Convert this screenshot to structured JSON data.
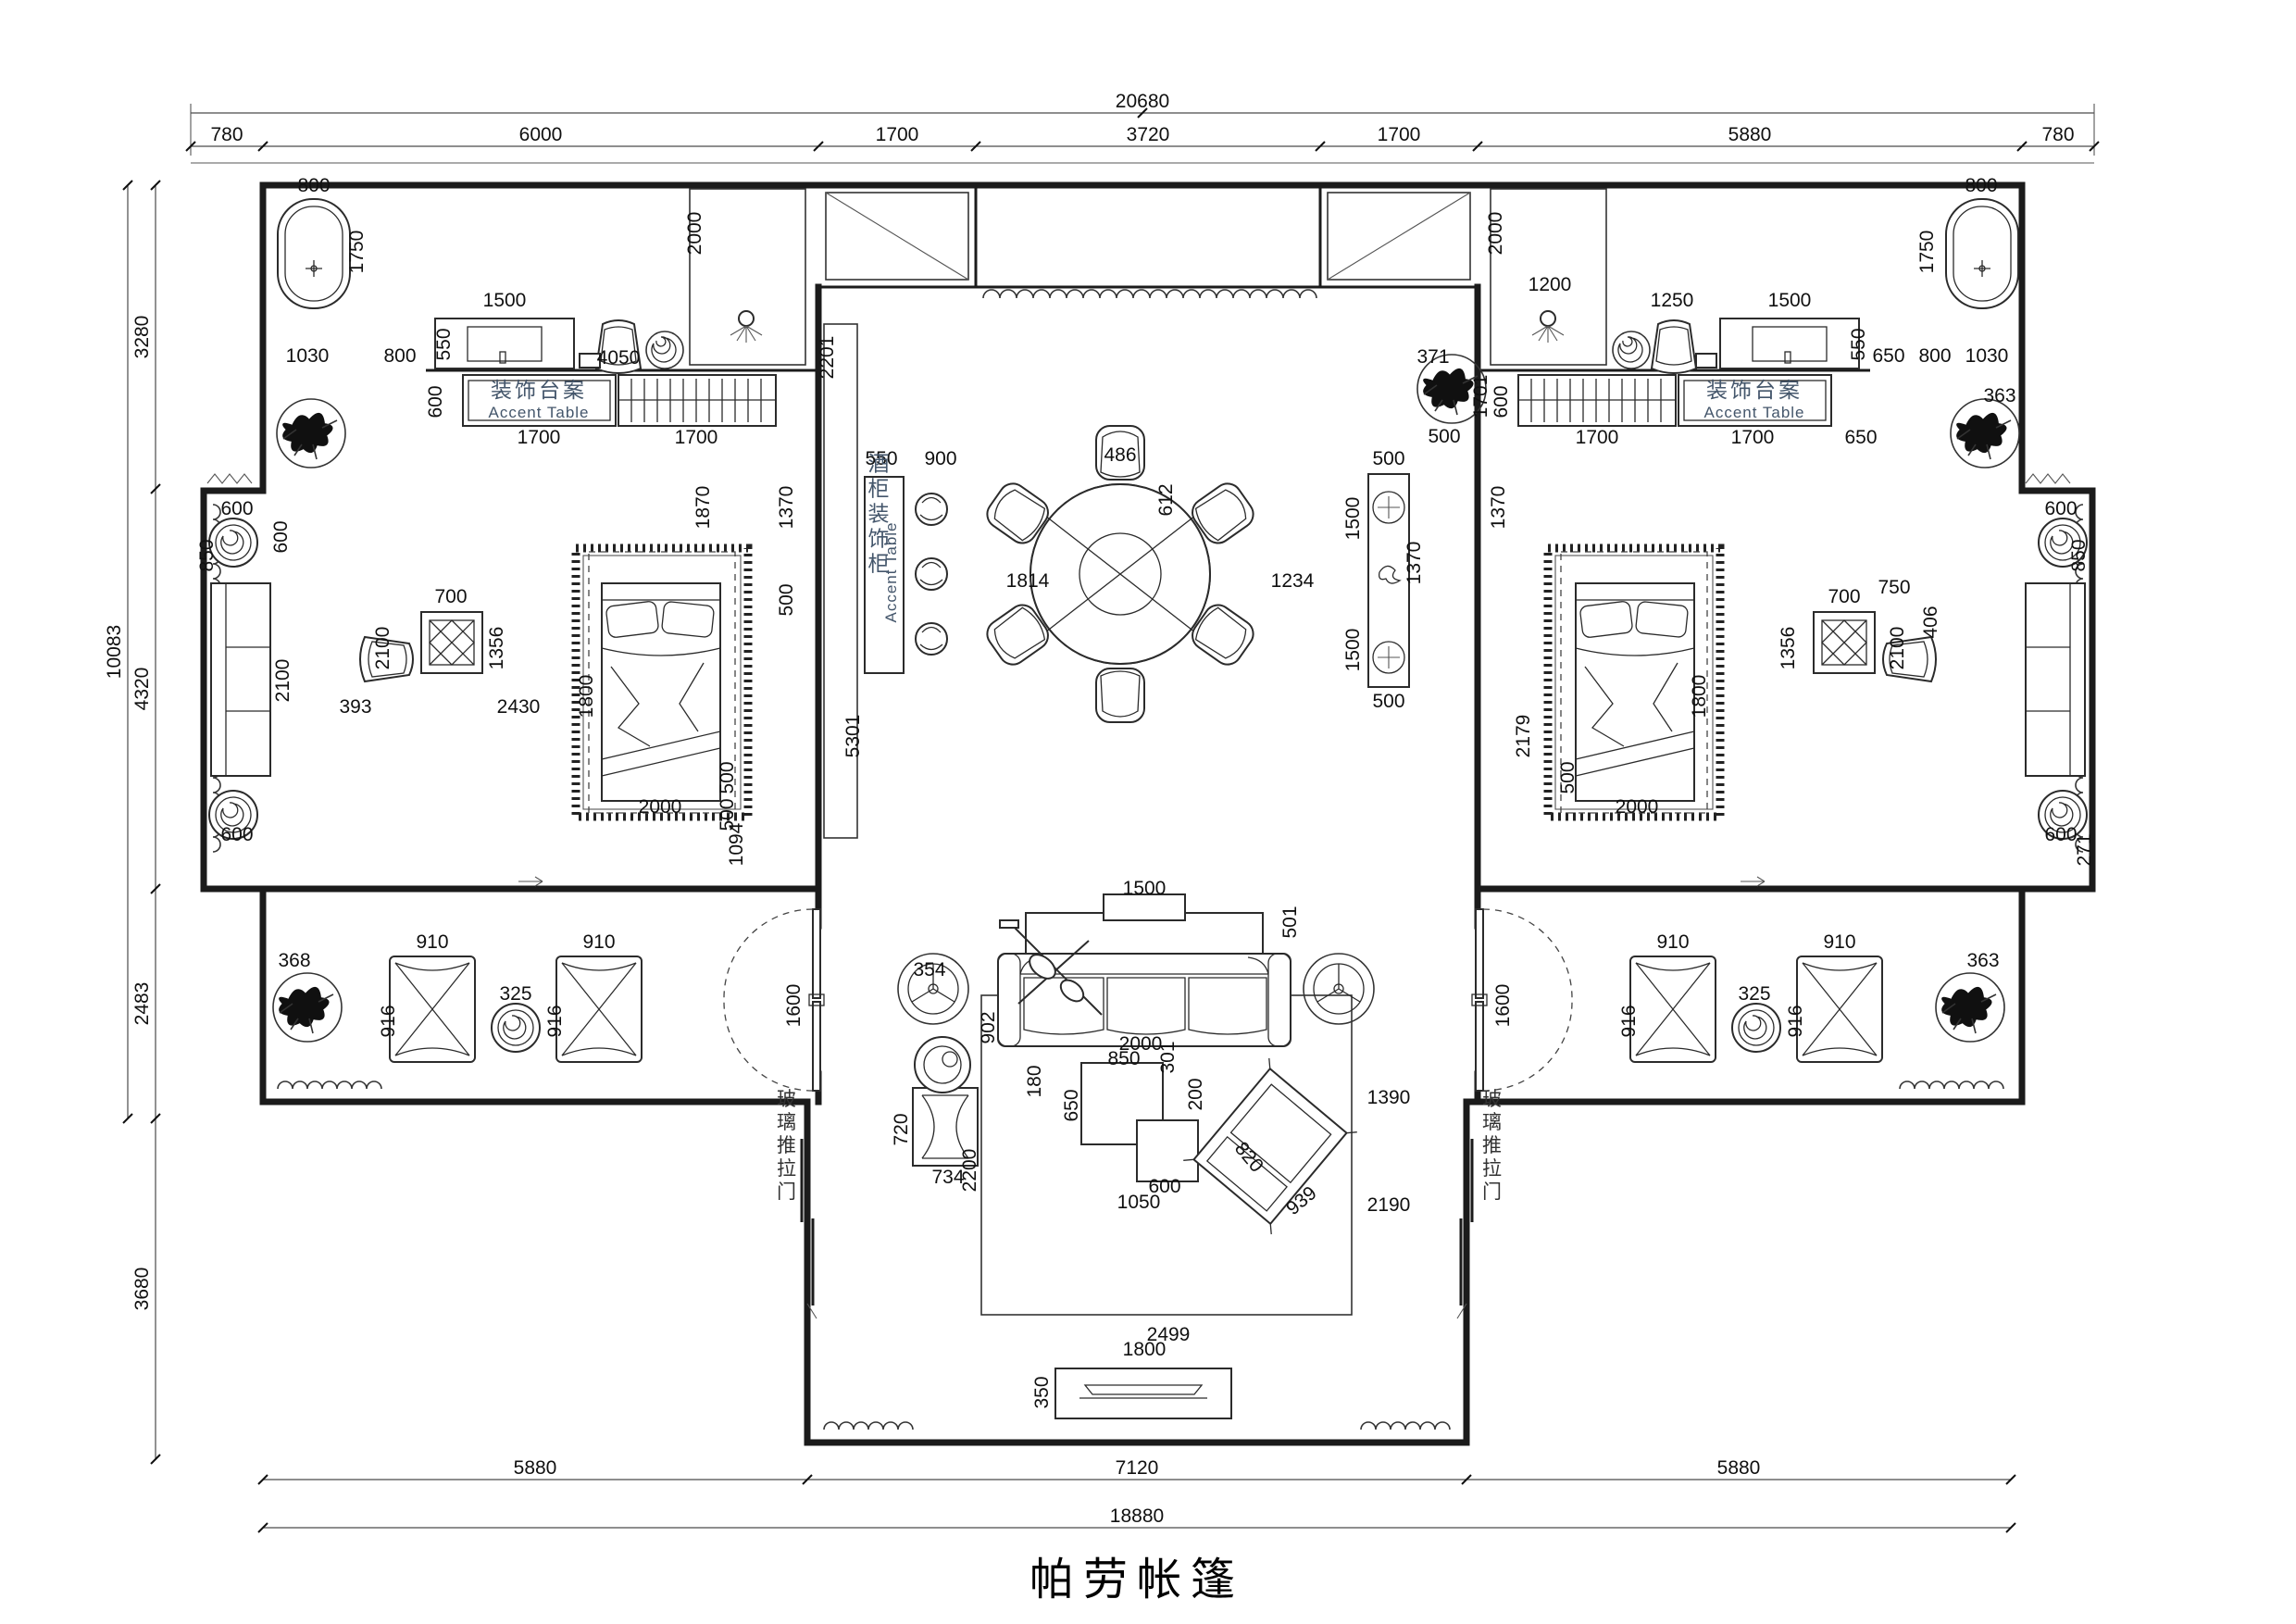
{
  "title": "帕劳帐篷",
  "labels": {
    "accent_table_cn": "装饰台案",
    "accent_table_en": "Accent Table",
    "bar_cabinet_cn": "酒柜装饰柜",
    "bar_cabinet_en": "Accent Table",
    "sliding_door": "玻璃推拉门"
  },
  "dimensions": {
    "top_total": "20680",
    "top_segments": [
      "780",
      "6000",
      "1700",
      "3720",
      "1700",
      "5880",
      "780"
    ],
    "left_total": "10083",
    "left_segments": [
      "3280",
      "4320",
      "2483"
    ],
    "left_lower": "3680",
    "bottom_segments": [
      "5880",
      "7120",
      "5880"
    ],
    "bottom_total": "18880"
  },
  "annotations": [
    [
      "20680",
      1234,
      116
    ],
    [
      "780",
      245,
      152
    ],
    [
      "6000",
      584,
      152
    ],
    [
      "1700",
      969,
      152
    ],
    [
      "3720",
      1240,
      152
    ],
    [
      "1700",
      1511,
      152
    ],
    [
      "5880",
      1890,
      152
    ],
    [
      "780",
      2223,
      152
    ],
    [
      "10083",
      130,
      704,
      -90
    ],
    [
      "3280",
      160,
      364,
      -90
    ],
    [
      "4320",
      160,
      744,
      -90
    ],
    [
      "2483",
      160,
      1084,
      -90
    ],
    [
      "3680",
      160,
      1392,
      -90
    ],
    [
      "5880",
      578,
      1592
    ],
    [
      "7120",
      1228,
      1592
    ],
    [
      "5880",
      1878,
      1592
    ],
    [
      "18880",
      1228,
      1644
    ],
    [
      "800",
      339,
      207
    ],
    [
      "1750",
      392,
      272,
      -90
    ],
    [
      "1030",
      332,
      391
    ],
    [
      "800",
      432,
      391
    ],
    [
      "550",
      486,
      372,
      -90
    ],
    [
      "1500",
      545,
      331
    ],
    [
      "4050",
      668,
      393
    ],
    [
      "600",
      477,
      434,
      -90
    ],
    [
      "1700",
      582,
      479
    ],
    [
      "1700",
      752,
      479
    ],
    [
      "2000",
      757,
      252,
      -90
    ],
    [
      "1870",
      766,
      548,
      -90
    ],
    [
      "1370",
      856,
      548,
      -90
    ],
    [
      "500",
      856,
      648,
      -90
    ],
    [
      "2430",
      560,
      770
    ],
    [
      "700",
      487,
      651
    ],
    [
      "1356",
      543,
      700,
      -90
    ],
    [
      "2100",
      420,
      700,
      -90
    ],
    [
      "393",
      384,
      770
    ],
    [
      "1800",
      640,
      752,
      -90
    ],
    [
      "2000",
      713,
      878
    ],
    [
      "500",
      792,
      840,
      -90
    ],
    [
      "500",
      792,
      880,
      -90
    ],
    [
      "1094",
      802,
      912,
      -90
    ],
    [
      "600",
      256,
      556
    ],
    [
      "850",
      230,
      600,
      -90
    ],
    [
      "600",
      310,
      580,
      -90
    ],
    [
      "600",
      256,
      908
    ],
    [
      "2100",
      312,
      735,
      -90
    ],
    [
      "368",
      318,
      1044
    ],
    [
      "910",
      467,
      1024
    ],
    [
      "910",
      647,
      1024
    ],
    [
      "325",
      557,
      1080
    ],
    [
      "916",
      426,
      1103,
      -90
    ],
    [
      "916",
      606,
      1103,
      -90
    ],
    [
      "1600",
      864,
      1086,
      -90
    ],
    [
      "2201",
      900,
      386,
      -90
    ],
    [
      "550",
      952,
      502
    ],
    [
      "900",
      1016,
      502
    ],
    [
      "5301",
      928,
      795,
      -90
    ],
    [
      "486",
      1210,
      498
    ],
    [
      "612",
      1266,
      540,
      -90
    ],
    [
      "1814",
      1110,
      634
    ],
    [
      "1234",
      1396,
      634
    ],
    [
      "1500",
      1468,
      560,
      -90
    ],
    [
      "1500",
      1468,
      702,
      -90
    ],
    [
      "500",
      1500,
      502
    ],
    [
      "1370",
      1534,
      608,
      -90
    ],
    [
      "500",
      1500,
      764
    ],
    [
      "371",
      1548,
      392
    ],
    [
      "1701",
      1606,
      428,
      -90
    ],
    [
      "500",
      1560,
      478
    ],
    [
      "2000",
      1622,
      252,
      -90
    ],
    [
      "1200",
      1674,
      314
    ],
    [
      "1250",
      1806,
      331
    ],
    [
      "1500",
      1933,
      331
    ],
    [
      "550",
      2014,
      372,
      -90
    ],
    [
      "650",
      2040,
      391
    ],
    [
      "800",
      2090,
      391
    ],
    [
      "1030",
      2146,
      391
    ],
    [
      "800",
      2140,
      207
    ],
    [
      "1750",
      2088,
      272,
      -90
    ],
    [
      "363",
      2160,
      434
    ],
    [
      "600",
      1628,
      434,
      -90
    ],
    [
      "1700",
      1725,
      479
    ],
    [
      "1700",
      1893,
      479
    ],
    [
      "650",
      2010,
      479
    ],
    [
      "1370",
      1625,
      548,
      -90
    ],
    [
      "2179",
      1652,
      795,
      -90
    ],
    [
      "500",
      1700,
      840,
      -90
    ],
    [
      "2000",
      1768,
      878
    ],
    [
      "1800",
      1842,
      752,
      -90
    ],
    [
      "700",
      1992,
      651
    ],
    [
      "1356",
      1938,
      700,
      -90
    ],
    [
      "2100",
      2056,
      700,
      -90
    ],
    [
      "406",
      2092,
      672,
      -90
    ],
    [
      "750",
      2046,
      641
    ],
    [
      "600",
      2226,
      556
    ],
    [
      "850",
      2252,
      600,
      -90
    ],
    [
      "600",
      2226,
      908
    ],
    [
      "271",
      2258,
      918,
      -90
    ],
    [
      "363",
      2142,
      1044
    ],
    [
      "910",
      1807,
      1024
    ],
    [
      "910",
      1987,
      1024
    ],
    [
      "325",
      1895,
      1080
    ],
    [
      "916",
      1766,
      1103,
      -90
    ],
    [
      "916",
      1946,
      1103,
      -90
    ],
    [
      "1600",
      1630,
      1086,
      -90
    ],
    [
      "1500",
      1236,
      966
    ],
    [
      "501",
      1400,
      996,
      -90
    ],
    [
      "354",
      1004,
      1054
    ],
    [
      "902",
      1074,
      1110,
      -90
    ],
    [
      "2000",
      1232,
      1134
    ],
    [
      "850",
      1214,
      1150
    ],
    [
      "301",
      1268,
      1142,
      -90
    ],
    [
      "200",
      1298,
      1182,
      -90
    ],
    [
      "650",
      1164,
      1194,
      -90
    ],
    [
      "180",
      1124,
      1168,
      -90
    ],
    [
      "600",
      1258,
      1288
    ],
    [
      "1050",
      1230,
      1305
    ],
    [
      "2200",
      1054,
      1264,
      -90
    ],
    [
      "720",
      980,
      1220,
      -90
    ],
    [
      "734",
      1024,
      1278
    ],
    [
      "820",
      1344,
      1254,
      50
    ],
    [
      "939",
      1410,
      1302,
      -40
    ],
    [
      "1390",
      1500,
      1192
    ],
    [
      "2190",
      1500,
      1308
    ],
    [
      "2499",
      1262,
      1448
    ],
    [
      "1800",
      1236,
      1464
    ],
    [
      "350",
      1132,
      1504,
      -90
    ],
    [
      "玻璃推拉门",
      848,
      1238,
      0,
      "v dr"
    ],
    [
      "玻璃推拉门",
      1610,
      1238,
      0,
      "v dr"
    ],
    [
      "酒柜装饰柜",
      947,
      556,
      0,
      "v s cn"
    ],
    [
      "Accent Table",
      968,
      618,
      -90,
      "en"
    ]
  ]
}
